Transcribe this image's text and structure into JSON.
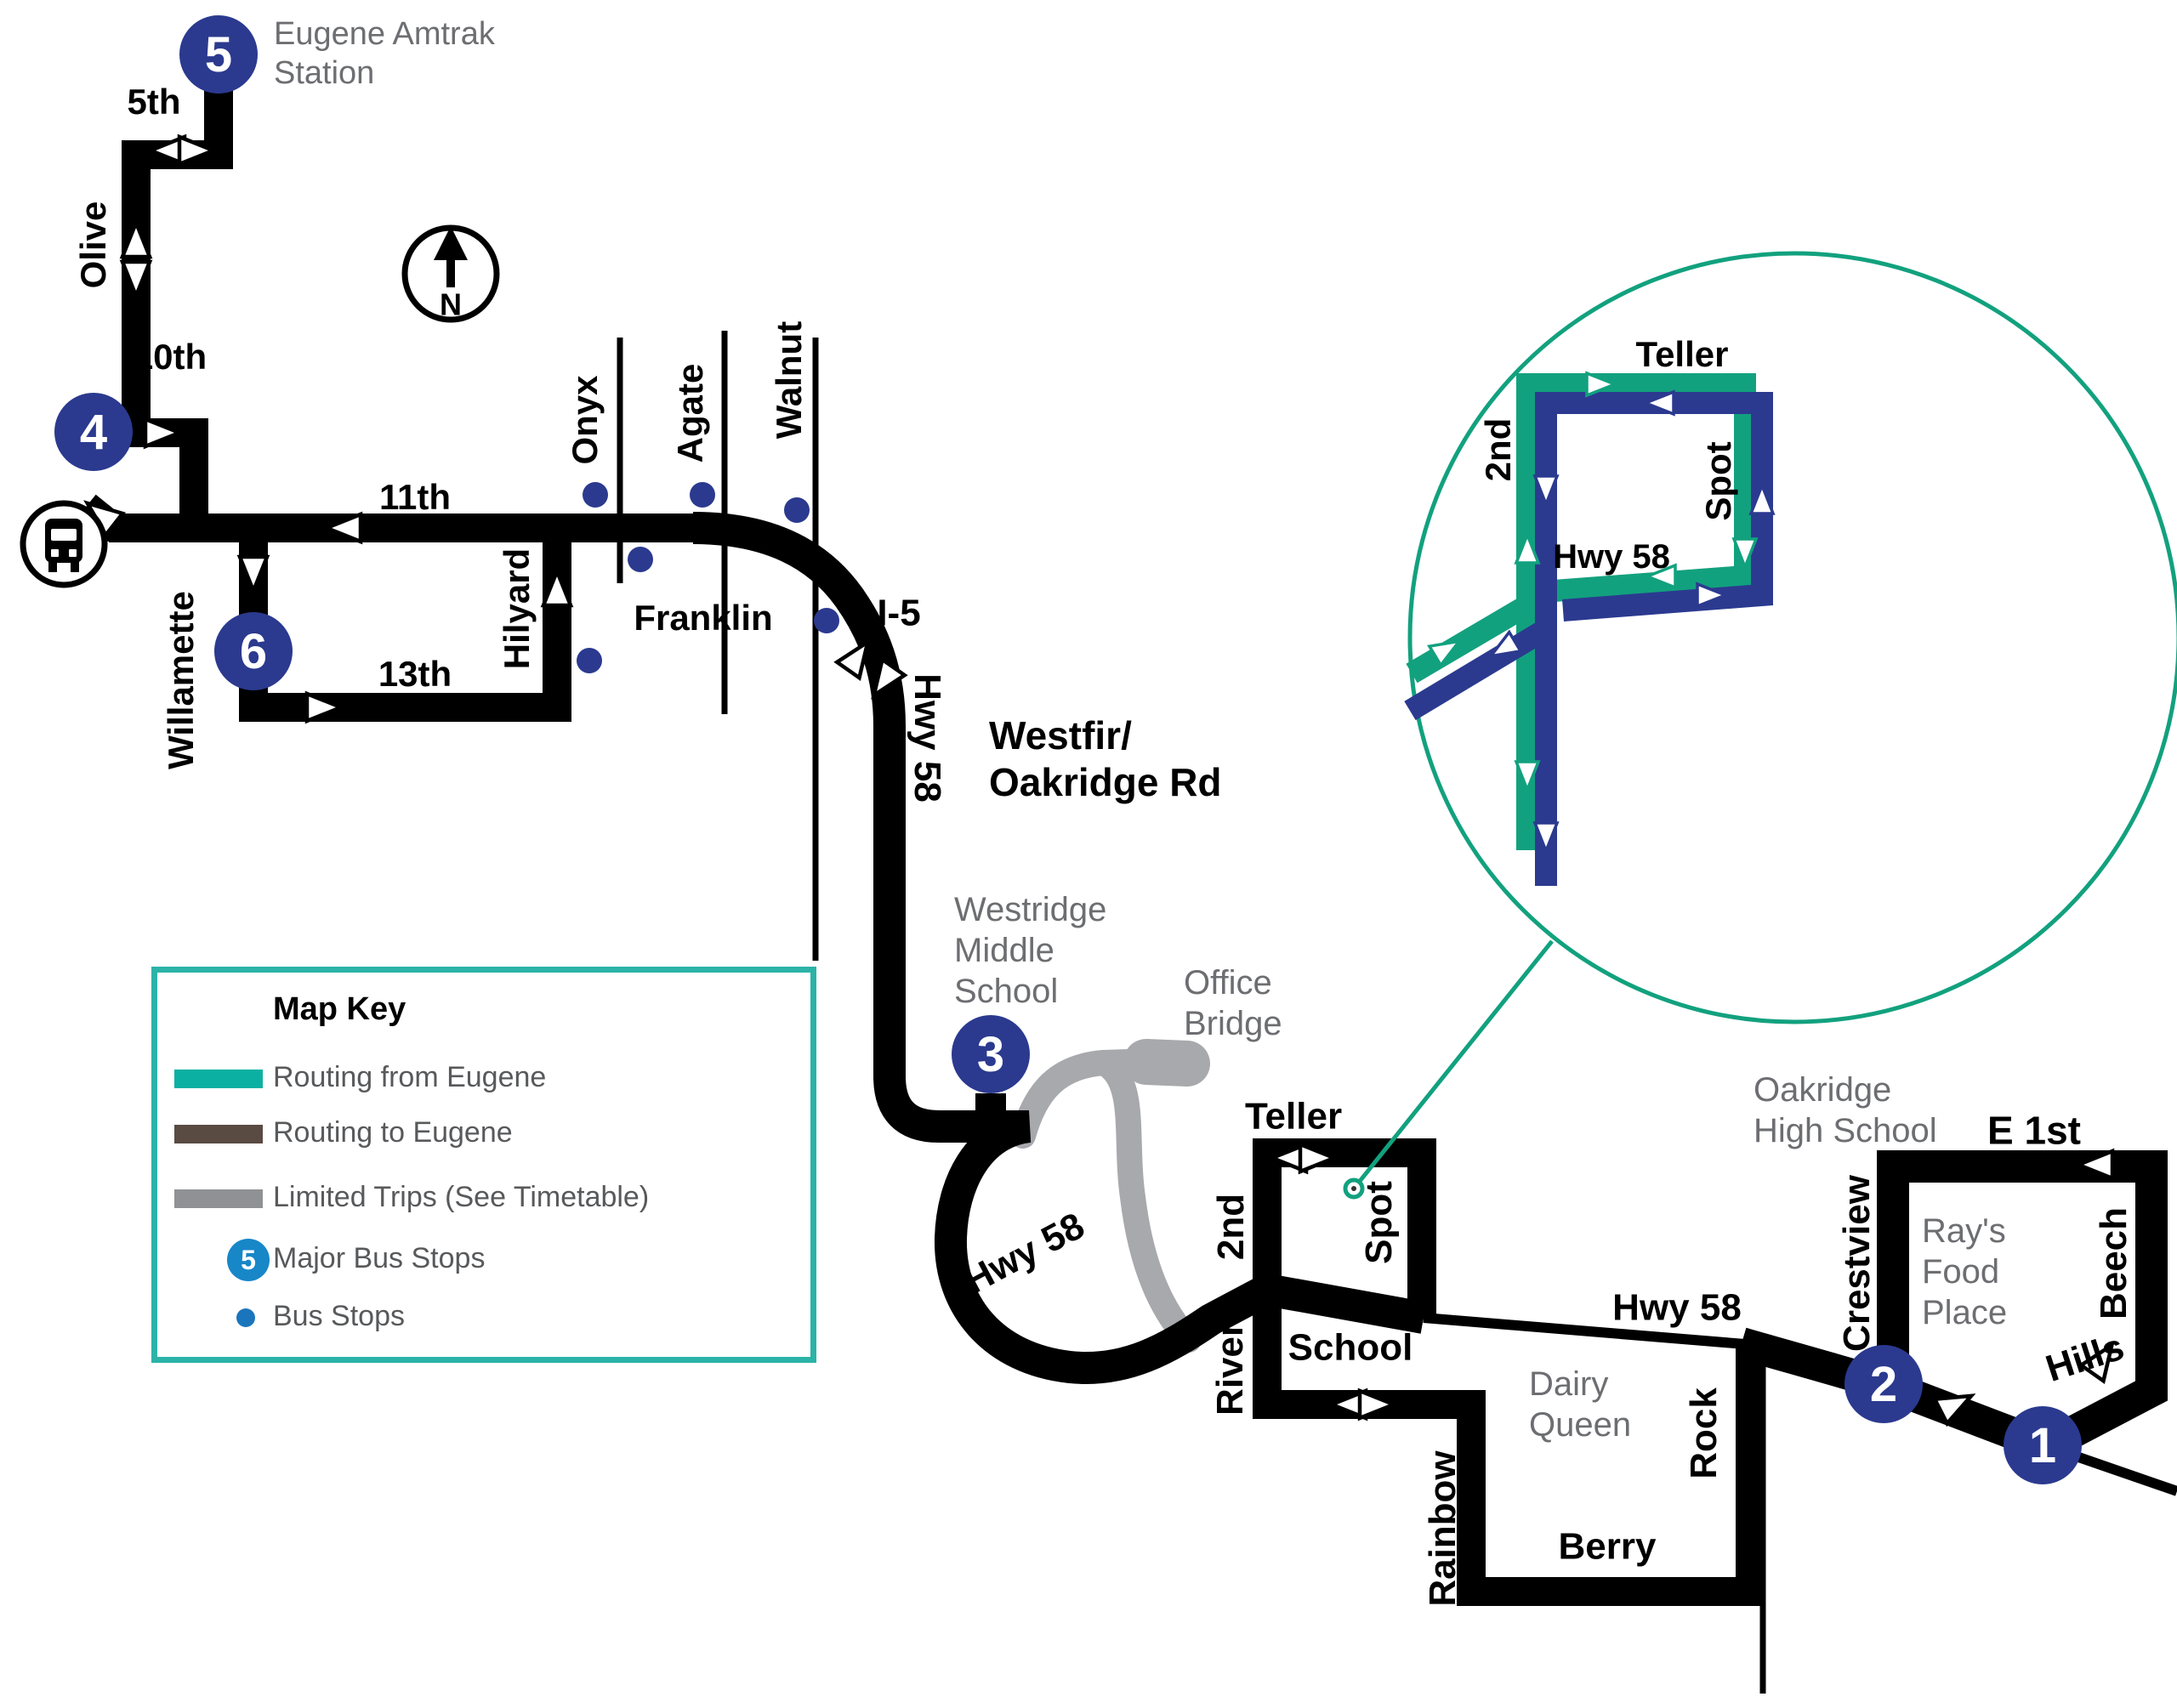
{
  "colors": {
    "route_black": "#000000",
    "navy": "#2B3A8F",
    "teal_swatch": "#0CB0A3",
    "inset_green": "#12A17E",
    "brown": "#594A42",
    "limited_gray": "#A7A9AC",
    "key_border_teal": "#2BB3A8",
    "key_badge_blue": "#1787C8",
    "key_dot_blue": "#1B75BC",
    "label_gray": "#6D6E71",
    "key_text_gray": "#58595B"
  },
  "compass": {
    "n": "N"
  },
  "stops": {
    "s1": "1",
    "s2": "2",
    "s3": "3",
    "s4": "4",
    "s5": "5",
    "s6": "6"
  },
  "map_key": {
    "title": "Map Key",
    "major_stop_badge": "5",
    "items": [
      {
        "label": "Routing from Eugene"
      },
      {
        "label": "Routing to Eugene"
      },
      {
        "label": "Limited Trips (See Timetable)"
      },
      {
        "label": "Major Bus Stops"
      },
      {
        "label": "Bus Stops"
      }
    ]
  },
  "labels": {
    "amtrak_station": "Eugene Amtrak\nStation",
    "fifth": "5th",
    "olive": "Olive",
    "tenth": "10th",
    "eleventh": "11th",
    "willamette": "Willamette",
    "thirteenth": "13th",
    "hilyard": "Hilyard",
    "onyx": "Onyx",
    "agate": "Agate",
    "walnut": "Walnut",
    "franklin": "Franklin",
    "i5": "I-5",
    "hwy58_i5": "Hwy 58",
    "westfir_oakridge_rd": "Westfir/\nOakridge Rd",
    "westridge_middle_school": "Westridge\nMiddle\nSchool",
    "office_bridge": "Office\nBridge",
    "hwy58_curve": "Hwy 58",
    "teller": "Teller",
    "second": "2nd",
    "spot": "Spot",
    "river": "River",
    "school": "School",
    "dairy_queen": "Dairy\nQueen",
    "hwy58_oakridge": "Hwy 58",
    "rock": "Rock",
    "rainbow": "Rainbow",
    "berry": "Berry",
    "oakridge_high_school": "Oakridge\nHigh School",
    "e_1st": "E 1st",
    "crestview": "Crestview",
    "rays_food_place": "Ray's\nFood\nPlace",
    "beech": "Beech",
    "hills": "Hills"
  },
  "inset": {
    "teller": "Teller",
    "second": "2nd",
    "spot": "Spot",
    "hwy58": "Hwy 58"
  }
}
